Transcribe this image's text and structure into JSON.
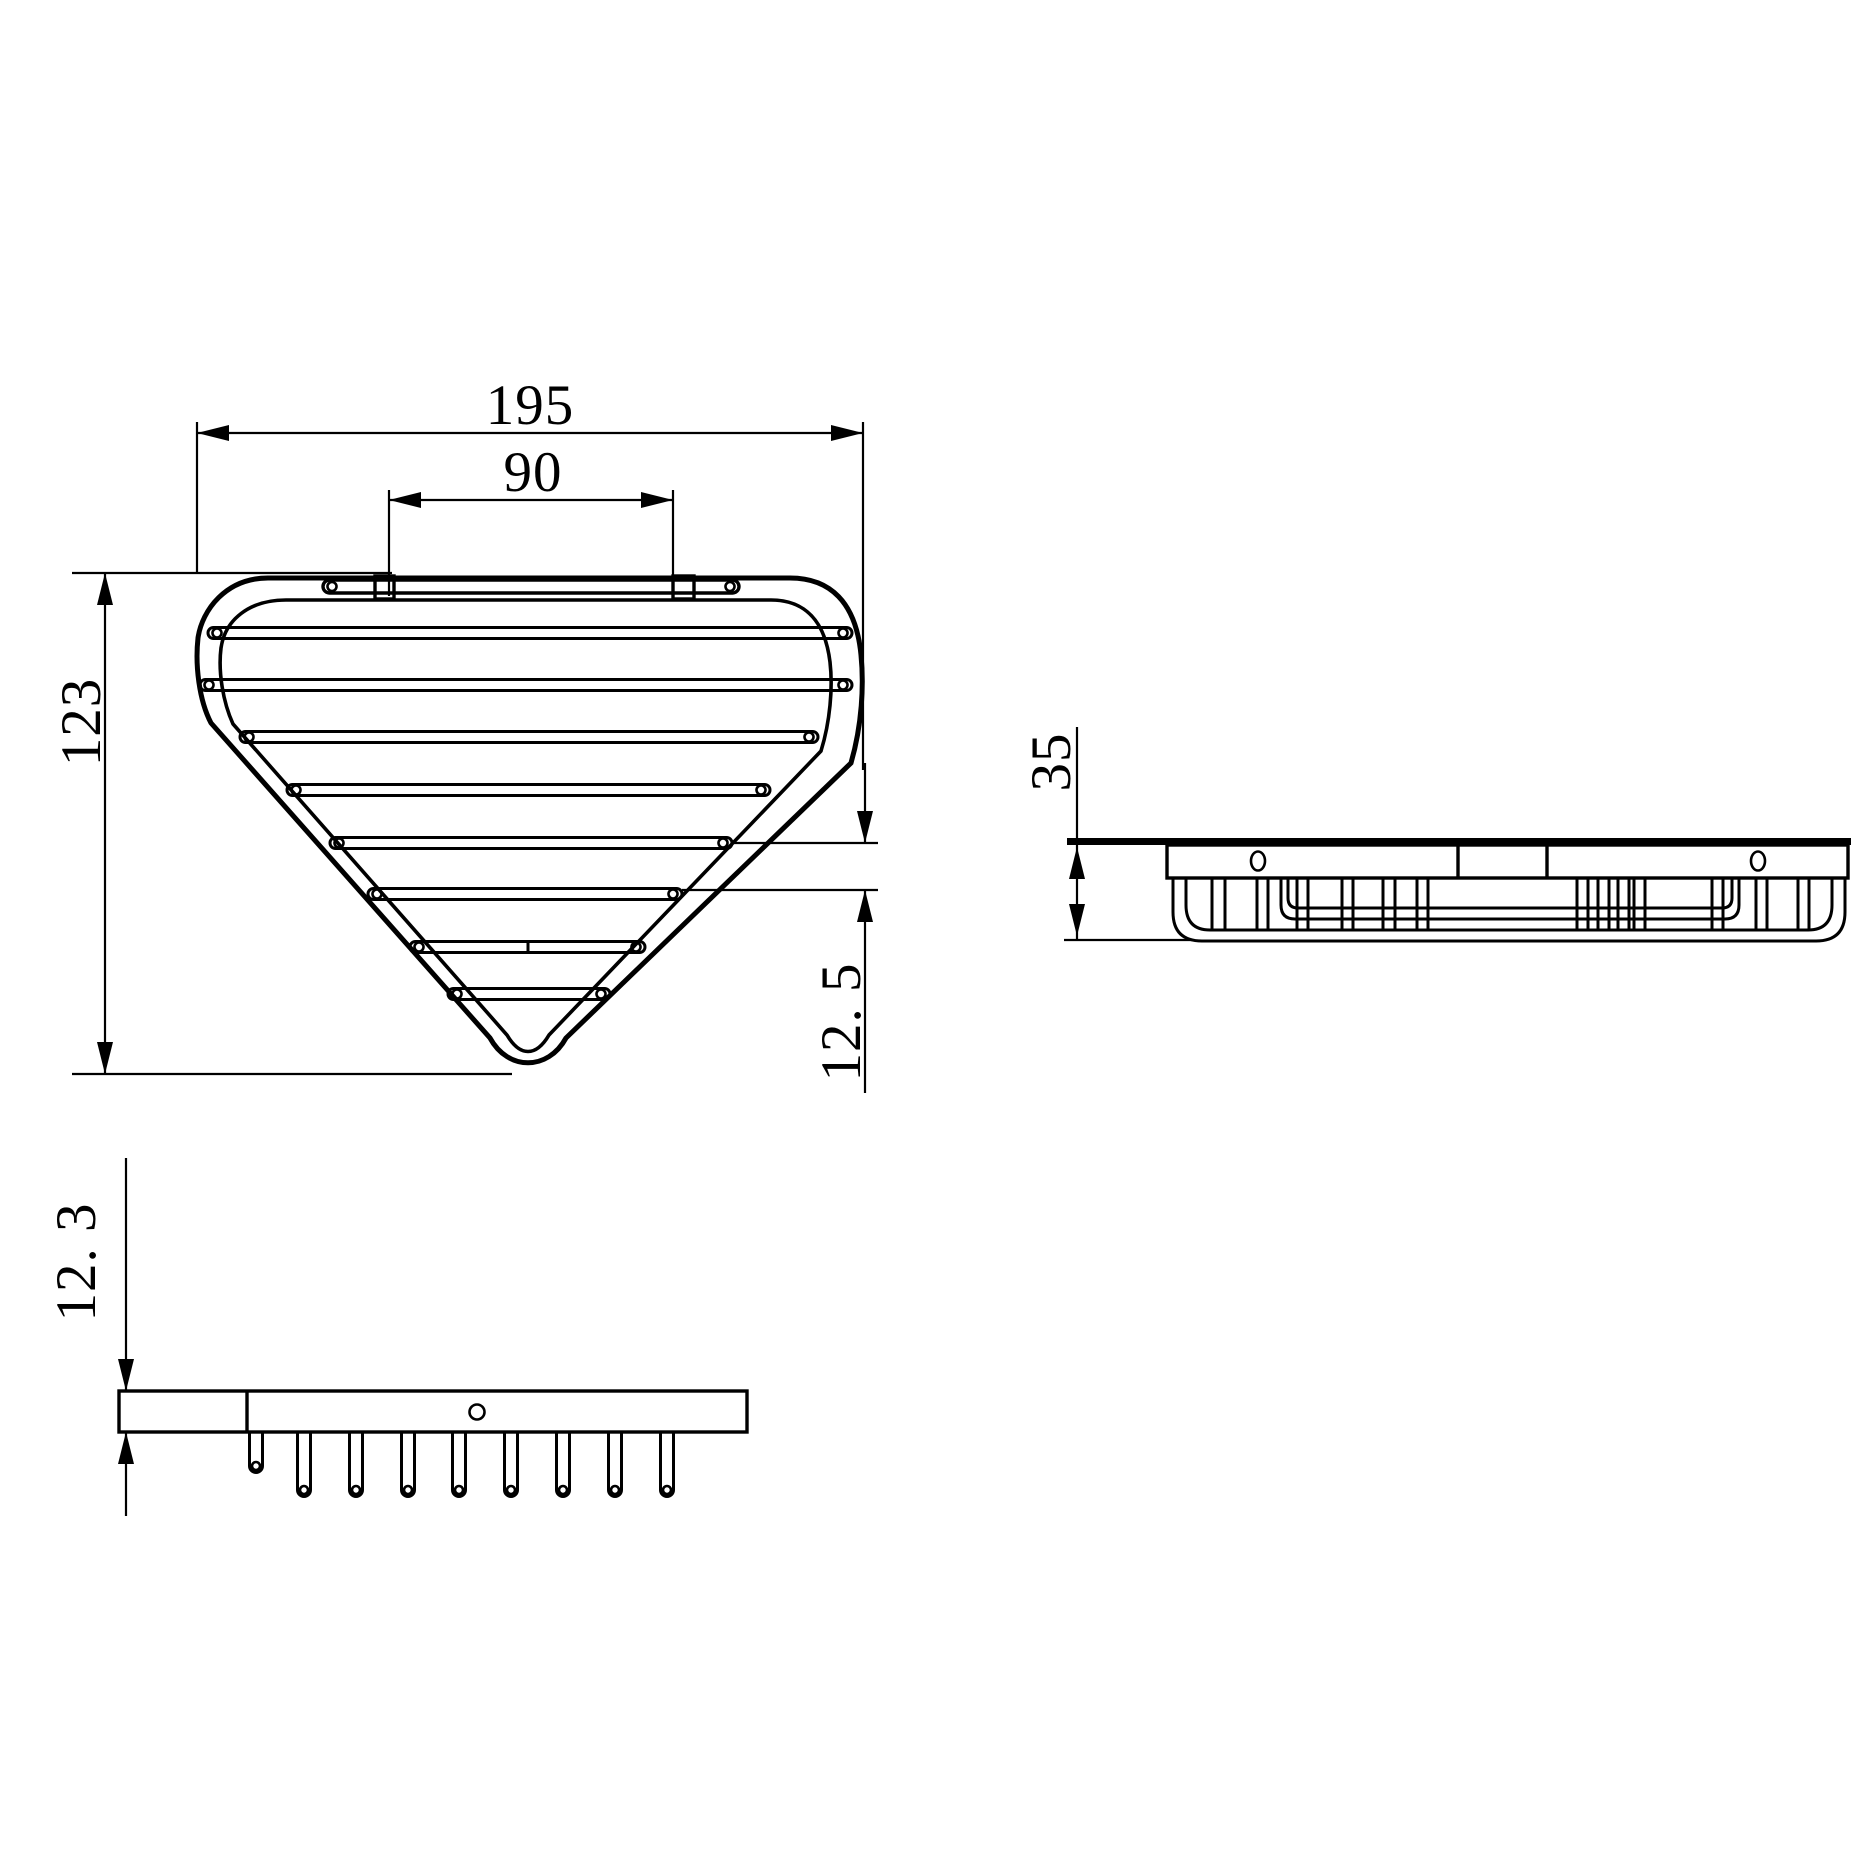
{
  "drawing": {
    "type": "technical-drawing",
    "product": "triangular corner wire basket",
    "background": "#ffffff",
    "line_color": "#000000",
    "views": {
      "top_view": "plan view of triangular wire basket",
      "side_view": "front elevation of basket",
      "rail_view": "side elevation of mounting rail with prongs"
    },
    "dimensions": {
      "overall_width": "195",
      "bracket_spacing": "90",
      "overall_depth": "123",
      "wire_gap": "12. 5",
      "side_height": "35",
      "rail_thickness": "12. 3"
    }
  }
}
